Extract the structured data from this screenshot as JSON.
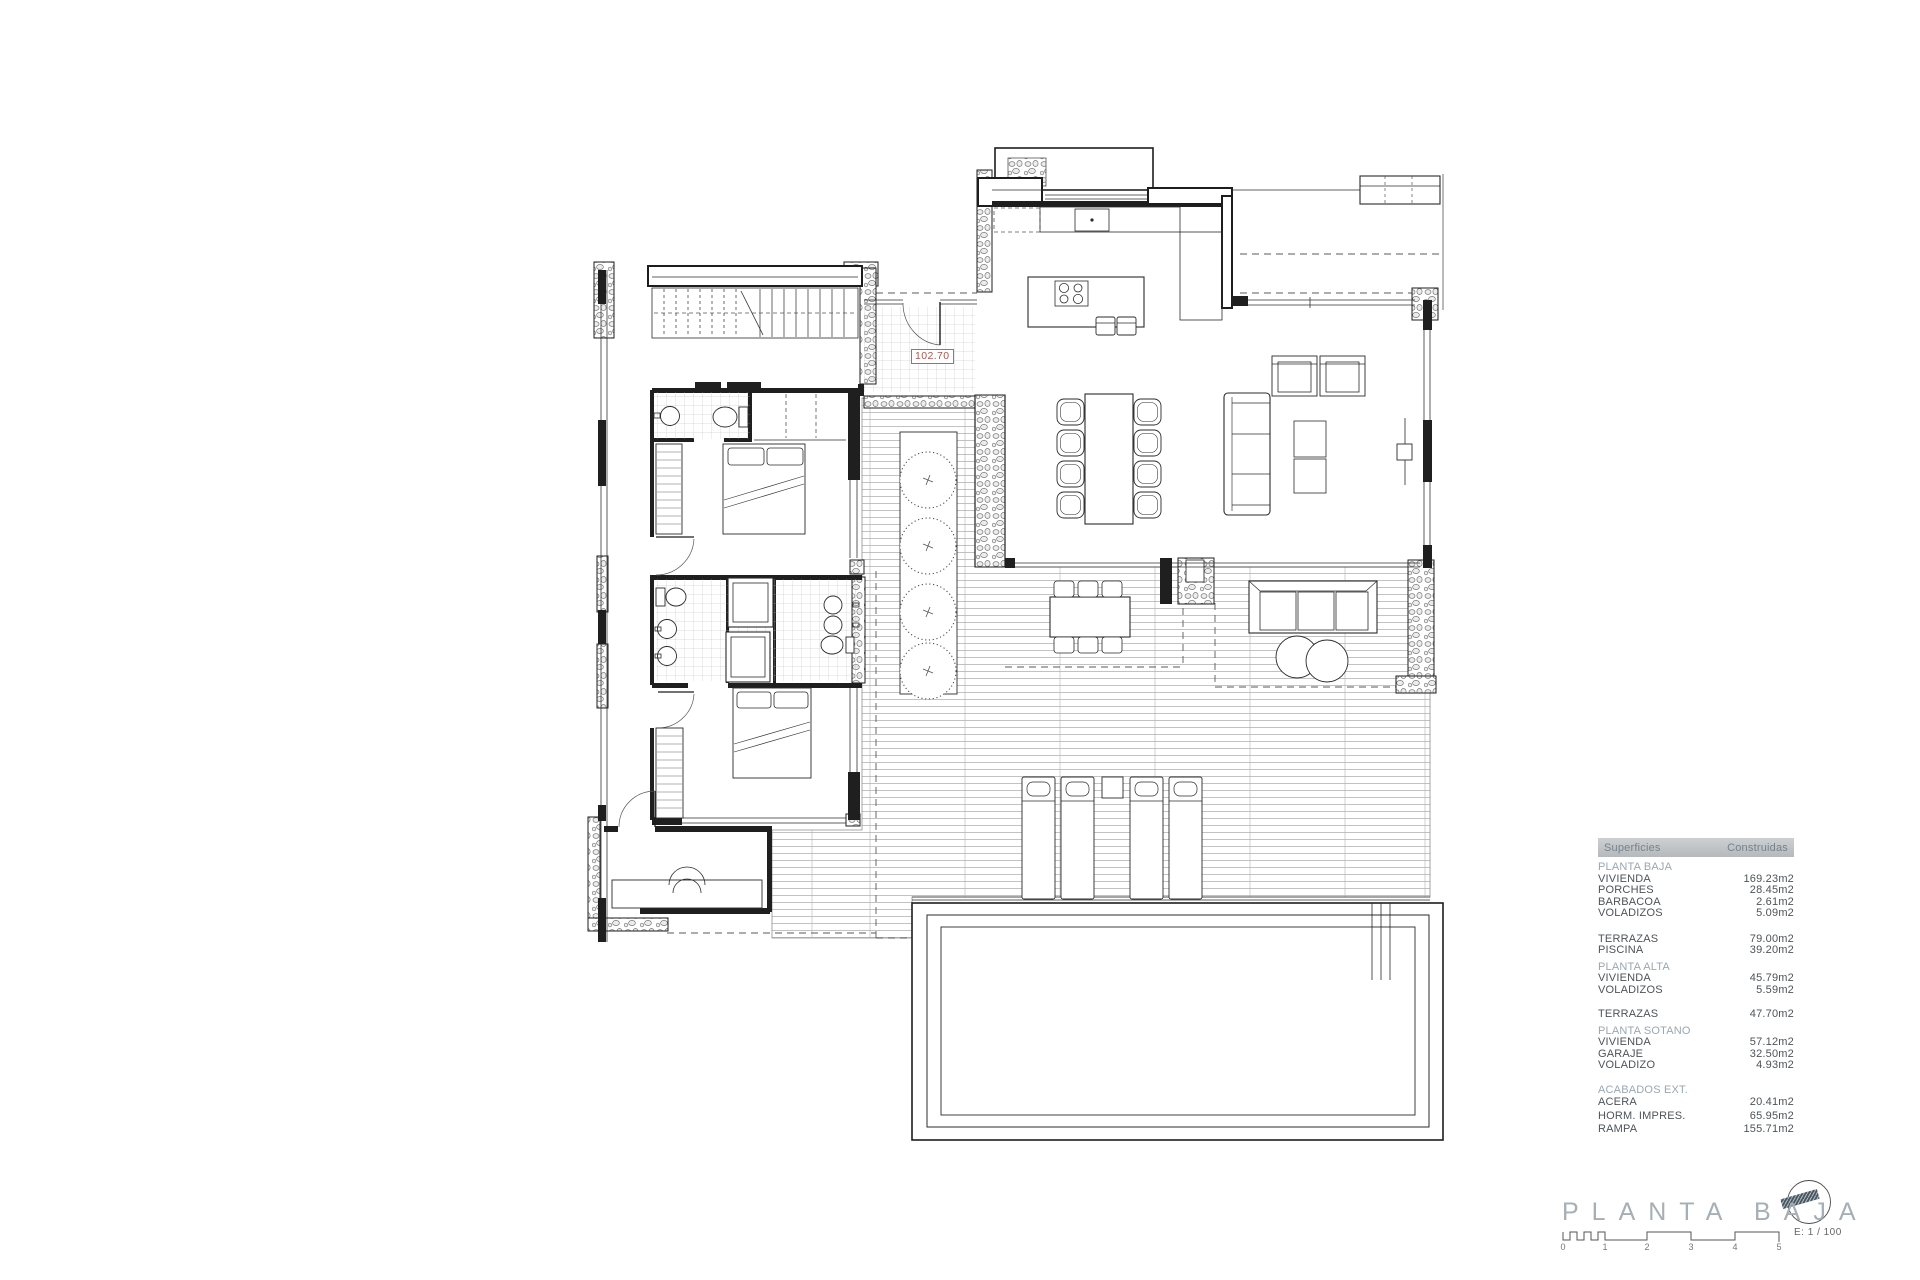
{
  "plan": {
    "level_label": "102.70",
    "accent_red": "#a9584e"
  },
  "table": {
    "header": {
      "col1": "Superficies",
      "col2": "Construidas"
    },
    "sections": [
      {
        "title": "PLANTA BAJA",
        "rows": [
          [
            "VIVIENDA",
            "169.23m2"
          ],
          [
            "PORCHES",
            "28.45m2"
          ],
          [
            "BARBACOA",
            "2.61m2"
          ],
          [
            "VOLADIZOS",
            "5.09m2"
          ]
        ]
      },
      {
        "title": "",
        "rows": [
          [
            "TERRAZAS",
            "79.00m2"
          ],
          [
            "PISCINA",
            "39.20m2"
          ]
        ]
      },
      {
        "title": "PLANTA ALTA",
        "rows": [
          [
            "VIVIENDA",
            "45.79m2"
          ],
          [
            "VOLADIZOS",
            "5.59m2"
          ]
        ]
      },
      {
        "title": "",
        "rows": [
          [
            "TERRAZAS",
            "47.70m2"
          ]
        ]
      },
      {
        "title": "PLANTA SOTANO",
        "rows": [
          [
            "VIVIENDA",
            "57.12m2"
          ],
          [
            "GARAJE",
            "32.50m2"
          ],
          [
            "VOLADIZO",
            "4.93m2"
          ]
        ]
      },
      {
        "title": "ACABADOS EXT.",
        "rows": [
          [
            "ACERA",
            "20.41m2"
          ],
          [
            "HORM. IMPRES.",
            "65.95m2"
          ],
          [
            "RAMPA",
            "155.71m2"
          ]
        ]
      }
    ]
  },
  "titleblock": {
    "title": "PLANTA BAJA",
    "scale_label": "E: 1 / 100",
    "scale_ticks": [
      "0",
      "1",
      "2",
      "3",
      "4",
      "5"
    ],
    "title_color": "#a6afb5"
  }
}
